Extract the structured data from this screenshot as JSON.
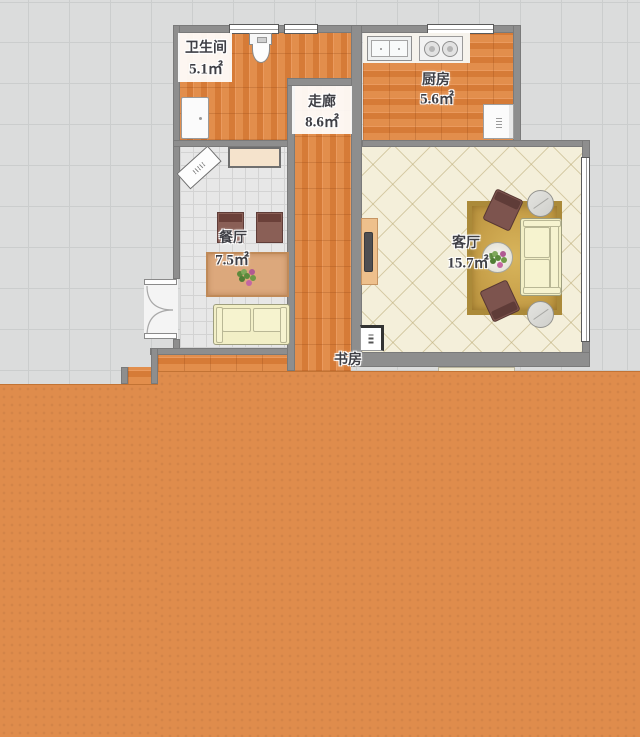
{
  "rooms": {
    "bathroom": {
      "name": "卫生间",
      "area": "5.1㎡"
    },
    "kitchen": {
      "name": "厨房",
      "area": "5.6㎡"
    },
    "corridor": {
      "name": "走廊",
      "area": "8.6㎡"
    },
    "dining": {
      "name": "餐厅",
      "area": "7.5㎡"
    },
    "living": {
      "name": "客厅",
      "area": "15.7㎡"
    },
    "study": {
      "name": "书房"
    }
  },
  "colors": {
    "background_tile": "#dbdcdc",
    "wall": "#8e8e8e",
    "wood_floor": "#dd8343",
    "dining_floor": "#e7e7e7",
    "living_floor": "#f4efda",
    "overlay_orange": "#df8c4c",
    "rug_gold": "#c9a24b",
    "sofa_cream": "#f2efc6",
    "chair_brown": "#7d544e",
    "table_wood": "#dca87c"
  }
}
